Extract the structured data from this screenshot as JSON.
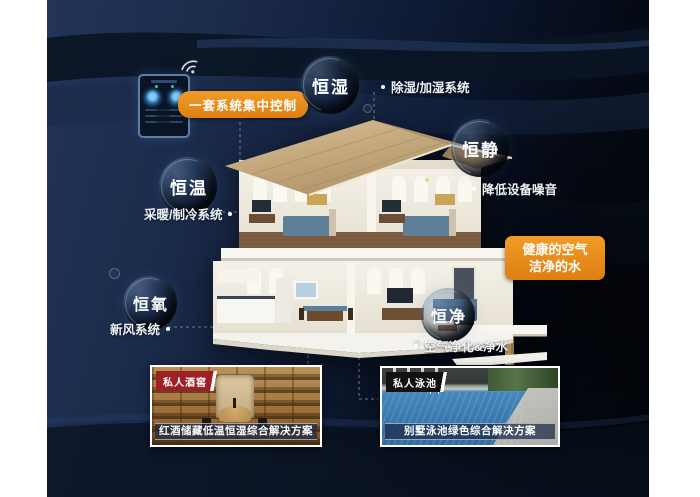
{
  "bubbles": [
    {
      "id": "humidity",
      "label": "恒湿"
    },
    {
      "id": "quiet",
      "label": "恒静"
    },
    {
      "id": "temperature",
      "label": "恒温"
    },
    {
      "id": "oxygen",
      "label": "恒氧"
    },
    {
      "id": "purity",
      "label": "恒净"
    }
  ],
  "callouts": {
    "humidity": "除湿/加湿系统",
    "quiet": "降低设备噪音",
    "temperature": "采暖/制冷系统",
    "oxygen": "新风系统",
    "purity": "空气净化&净水"
  },
  "control_label": "一套系统集中控制",
  "benefit_box": {
    "line1": "健康的空气",
    "line2": "洁净的水"
  },
  "photos": [
    {
      "badge": "私人酒窖",
      "caption": "红酒储藏低温恒湿综合解决方案"
    },
    {
      "badge": "私人泳池",
      "caption": "别墅泳池绿色综合解决方案"
    }
  ],
  "icons": {
    "wifi": "wifi-icon",
    "controller": "smart-home-app-phone"
  },
  "colors": {
    "accent_orange": "#E8891D",
    "background_navy": "#15243F",
    "badge_red": "#9E2025",
    "badge_black": "#121212",
    "roof_tan": "#C9AD82",
    "pool_blue": "#3A7BB2"
  }
}
